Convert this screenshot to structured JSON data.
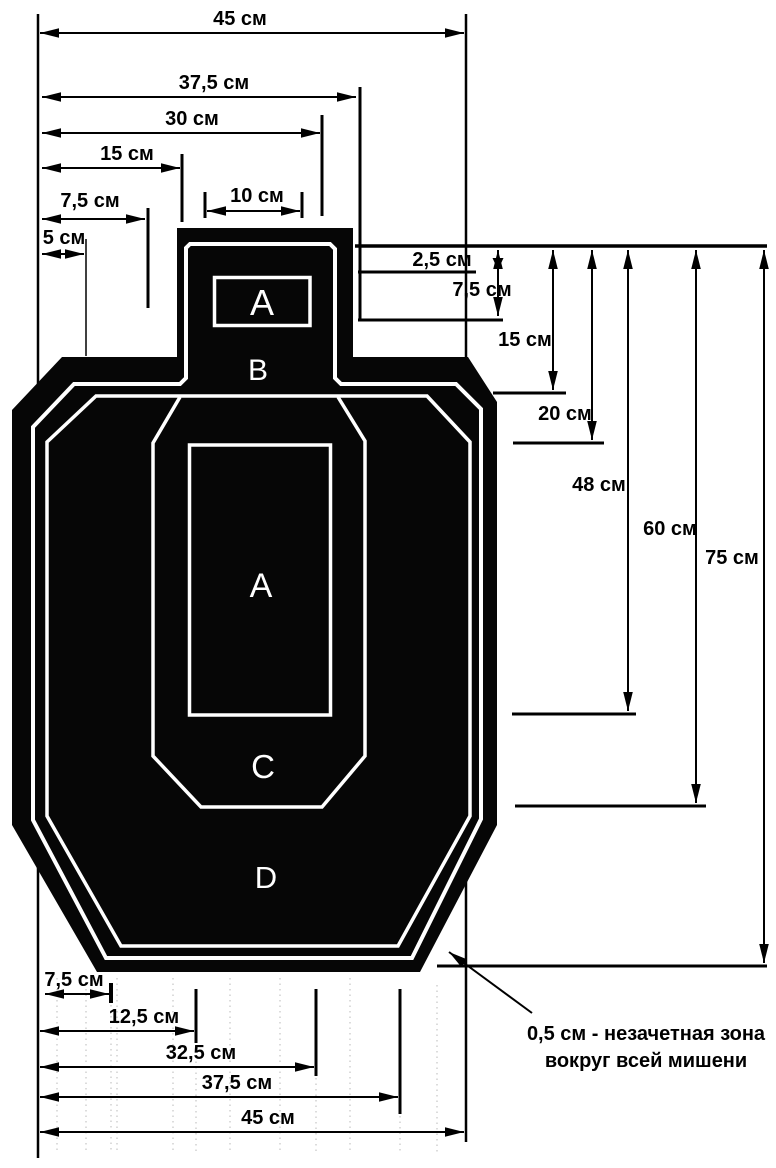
{
  "diagram": {
    "zones": {
      "head_a": "A",
      "head_b": "B",
      "body_a": "A",
      "body_c": "C",
      "body_d": "D"
    },
    "dims_top": [
      "45 см",
      "37,5 см",
      "30 см",
      "15 см",
      "10 см",
      "7,5 см",
      "5 см"
    ],
    "dims_right": [
      "2,5 см",
      "7,5 см",
      "15 см",
      "20 см",
      "48 см",
      "60 см",
      "75 см"
    ],
    "dims_bottom": [
      "7,5 см",
      "12,5 см",
      "32,5 см",
      "37,5 см",
      "45 см"
    ],
    "note": {
      "line1": "0,5 см - незачетная зона",
      "line2": "вокруг всей мишени"
    },
    "colors": {
      "ink": "#000000",
      "paper": "#ffffff",
      "target_fill": "#060606",
      "zone_line": "#ffffff"
    }
  }
}
